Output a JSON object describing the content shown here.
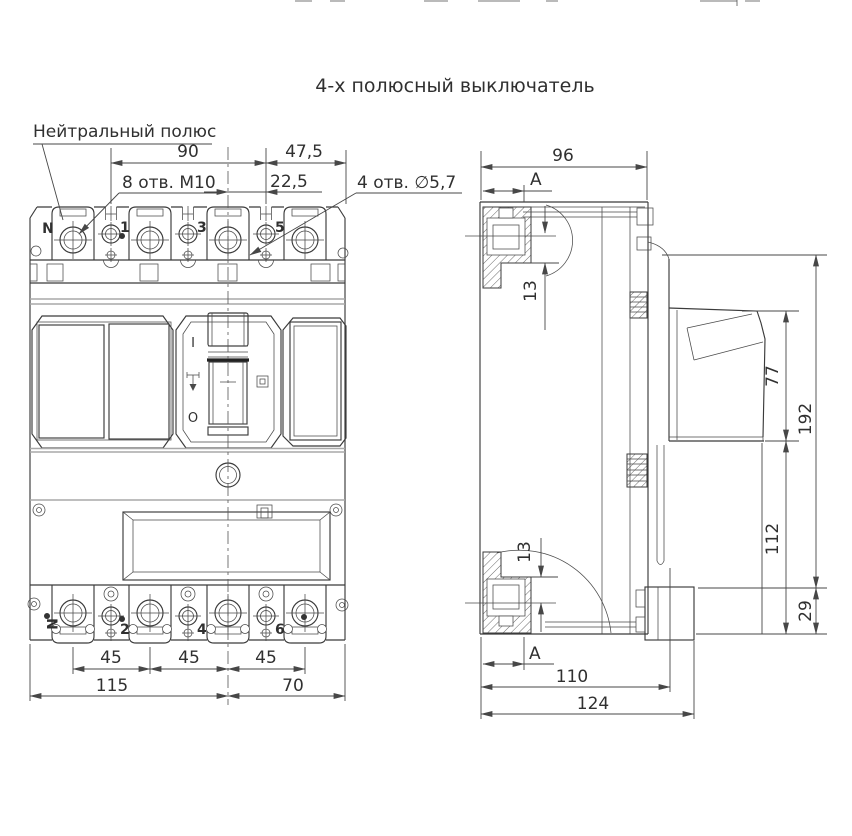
{
  "title": "4-х полюсный выключатель",
  "callouts": {
    "neutral_pole": "Нейтральный полюс",
    "mounting_holes": "8 отв. М10",
    "panel_holes": "4 отв. ∅5,7",
    "section_label_top": "А",
    "section_label_bottom": "А"
  },
  "front_view": {
    "terminals_top": [
      "N",
      "1",
      "3",
      "5"
    ],
    "terminals_bottom": [
      "N",
      "2",
      "4",
      "6"
    ],
    "toggle_marks": {
      "on": "I",
      "off": "O"
    },
    "dimensions": {
      "pole_span": "90",
      "right_span": "47,5",
      "half_pitch": "22,5",
      "pitch": [
        "45",
        "45",
        "45"
      ],
      "left_width": "115",
      "right_width": "70"
    }
  },
  "side_view": {
    "dimensions": {
      "depth": "96",
      "terminal_top": "13",
      "terminal_bottom": "13",
      "cover_height": "77",
      "total_height": "192",
      "base_height": "112",
      "bottom_step": "29",
      "mount_depth": "110",
      "total_depth": "124"
    }
  },
  "colors": {
    "line": "#3b3b3b",
    "joint_gray": "#a8a8a8",
    "text": "#303030",
    "background": "#ffffff"
  }
}
